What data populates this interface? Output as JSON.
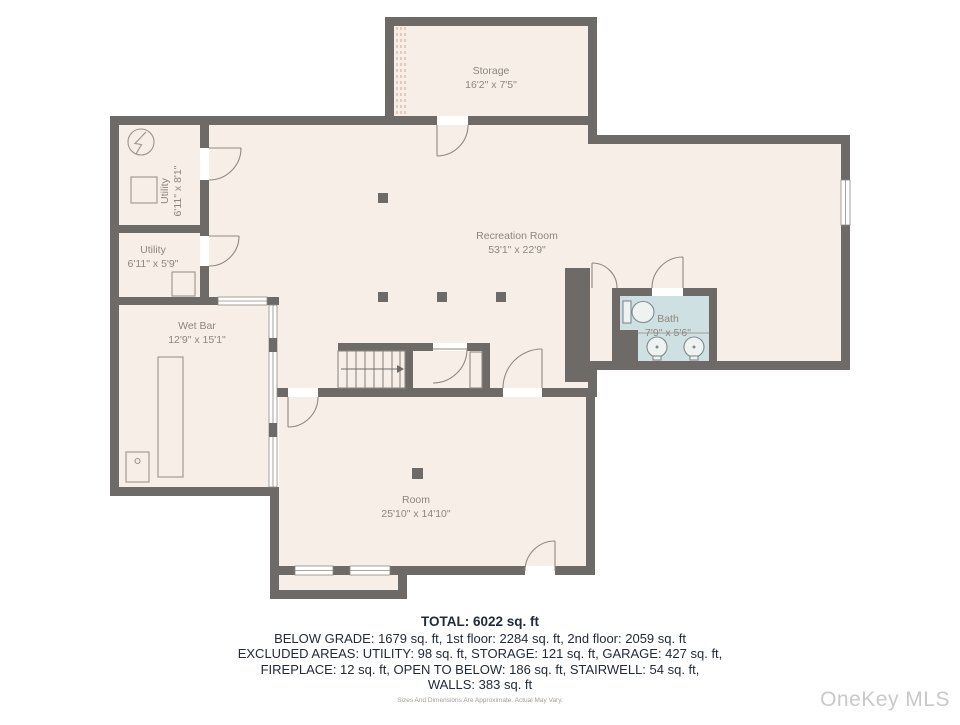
{
  "rooms": {
    "storage": {
      "name": "Storage",
      "dims": "16'2\" x 7'5\""
    },
    "utility_upper": {
      "name": "Utility",
      "dims": "6'11\" x 8'1\""
    },
    "utility_lower": {
      "name": "Utility",
      "dims": "6'11\" x 5'9\""
    },
    "recreation": {
      "name": "Recreation Room",
      "dims": "53'1\" x 22'9\""
    },
    "wet_bar": {
      "name": "Wet Bar",
      "dims": "12'9\" x 15'1\""
    },
    "bath": {
      "name": "Bath",
      "dims": "7'9\" x 5'6\""
    },
    "room": {
      "name": "Room",
      "dims": "25'10\" x 14'10\""
    }
  },
  "summary": {
    "total": "TOTAL: 6022 sq. ft",
    "line1": "BELOW GRADE: 1679 sq. ft, 1st floor: 2284 sq. ft, 2nd floor: 2059 sq. ft",
    "line2": "EXCLUDED AREAS: UTILITY: 98 sq. ft, STORAGE: 121 sq. ft, GARAGE: 427 sq. ft,",
    "line3": "FIREPLACE: 12 sq. ft, OPEN TO BELOW: 186 sq. ft, STAIRWELL: 54 sq. ft,",
    "line4": "WALLS: 383 sq. ft"
  },
  "disclaimer": "Sizes And Dimensions Are Approximate. Actual May Vary.",
  "watermark": "OneKey MLS",
  "colors": {
    "wall": "#6d6a68",
    "floor": "#f7eee8",
    "bath_floor": "#cfe0e2",
    "label_text": "#8d867e",
    "summary_text": "#222b38",
    "watermark_text": "#c9c9c9"
  }
}
